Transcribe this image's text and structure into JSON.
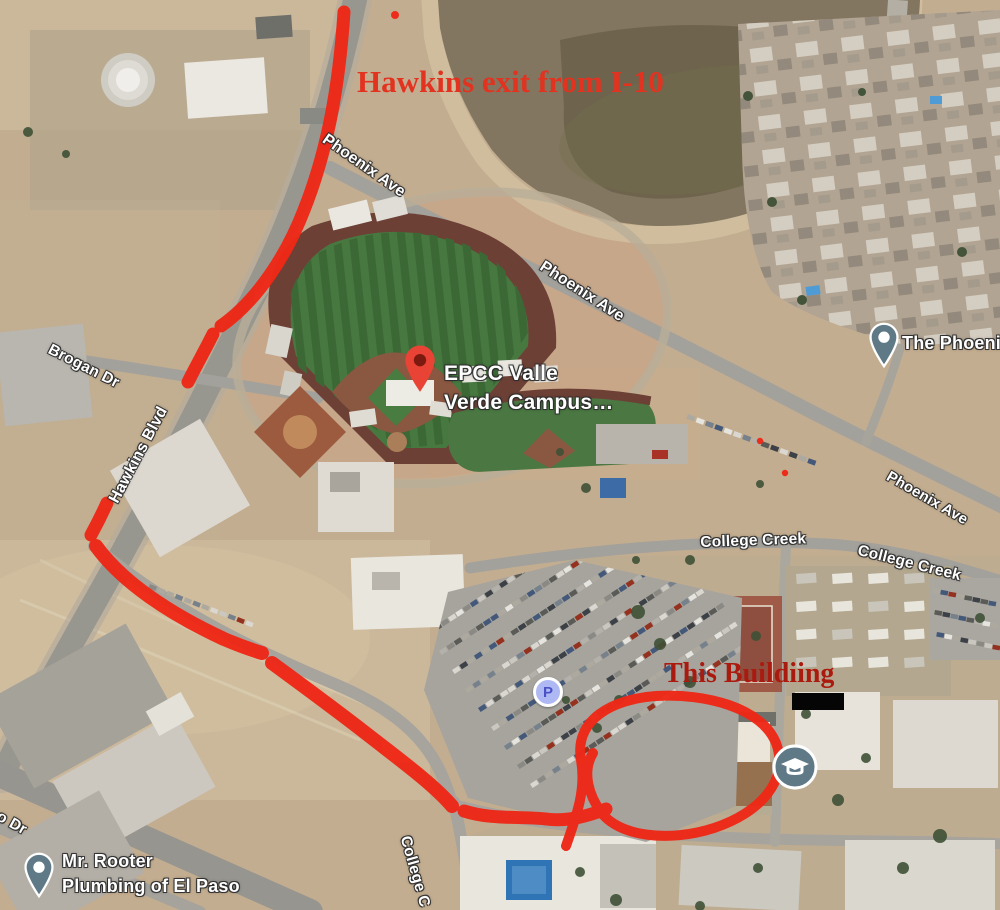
{
  "map": {
    "view_type": "satellite",
    "street_labels": [
      {
        "text": "Phoenix Ave",
        "x": 329,
        "y": 131,
        "rot": 35,
        "size": 16
      },
      {
        "text": "Phoenix Ave",
        "x": 546,
        "y": 258,
        "rot": 33,
        "size": 16
      },
      {
        "text": "Phoenix Ave",
        "x": 892,
        "y": 468,
        "rot": 30,
        "size": 15
      },
      {
        "text": "Brogan Dr",
        "x": 53,
        "y": 341,
        "rot": 27,
        "size": 15.5
      },
      {
        "text": "Hawkins Blvd",
        "x": 106,
        "y": 498,
        "rot": -62,
        "size": 16
      },
      {
        "text": "College Creek",
        "x": 700,
        "y": 534,
        "rot": -2,
        "size": 15.5
      },
      {
        "text": "College Creek",
        "x": 860,
        "y": 542,
        "rot": 14,
        "size": 15.5
      },
      {
        "text": "College C",
        "x": 413,
        "y": 834,
        "rot": 74,
        "size": 15.5
      },
      {
        "text": "o Dr",
        "x": 2,
        "y": 808,
        "rot": 29,
        "size": 15.5
      }
    ],
    "poi_labels": [
      {
        "id": "epcc-campus-label",
        "lines": [
          "EPCC Valle",
          "Verde Campus…"
        ],
        "x": 444,
        "y": 359,
        "size": 21
      },
      {
        "id": "mr-rooter-label",
        "lines": [
          "Mr. Rooter",
          "Plumbing of El Paso"
        ],
        "x": 62,
        "y": 849,
        "size": 18
      },
      {
        "id": "the-phoenix-label",
        "lines": [
          "The Phoenix"
        ],
        "x": 902,
        "y": 331,
        "size": 18
      }
    ],
    "icons": {
      "parking_glyph": "P",
      "epcc_pin": "red-place-pin",
      "rooter_pin": "gray-place-pin",
      "phoenix_pin": "gray-place-pin",
      "education_pin": "graduation-cap-pin"
    },
    "colors": {
      "pin_red": "#e94335",
      "pin_gray": "#5f7987",
      "parking_fill": "#aeb9f4",
      "parking_letter": "#4b50c6"
    }
  },
  "annotations": {
    "exit_text": "Hawkins exit from I-10",
    "building_text": "This Buildiing",
    "route_color": "#ee2817",
    "exit_text_color": "#e23220",
    "building_text_color": "#ab1a0f",
    "redaction_bar": true
  }
}
